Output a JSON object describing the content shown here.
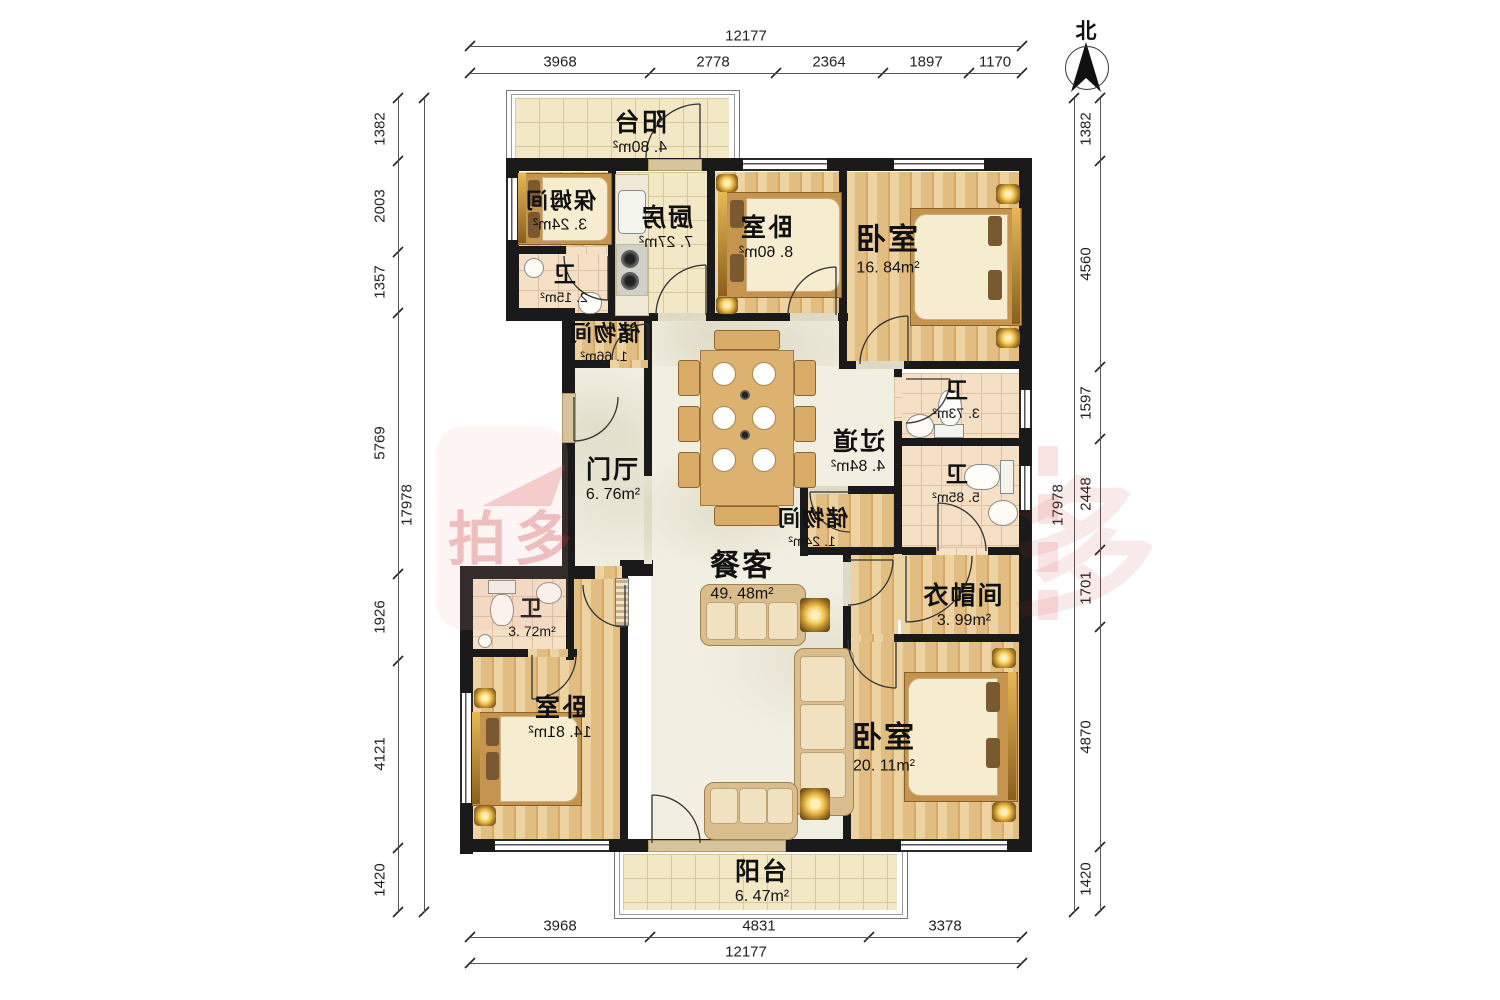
{
  "compass": {
    "label": "北"
  },
  "watermark": {
    "left_text": "拍多",
    "right_text": "多"
  },
  "dims": {
    "top": {
      "total": "12177",
      "segments": [
        "3968",
        "2778",
        "2364",
        "1897",
        "1170"
      ]
    },
    "bottom": {
      "total": "12177",
      "segments": [
        "3968",
        "4831",
        "3378"
      ]
    },
    "left": {
      "total": "17978",
      "segments": [
        "1382",
        "2003",
        "1357",
        "5769",
        "1926",
        "4121",
        "1420"
      ]
    },
    "right": {
      "total": "17978",
      "segments": [
        "1382",
        "4560",
        "1597",
        "2448",
        "1701",
        "4870",
        "1420"
      ]
    }
  },
  "rooms": [
    {
      "name": "阳台",
      "area": "4. 80m²"
    },
    {
      "name": "保姆间",
      "area": "3. 24m²"
    },
    {
      "name": "厨房",
      "area": "7. 27m²"
    },
    {
      "name": "卧室",
      "area": "8. 60m²"
    },
    {
      "name": "卧室",
      "area": "16. 84m²"
    },
    {
      "name": "卫",
      "area": "2. 15m²"
    },
    {
      "name": "储物间",
      "area": "1. 66m²"
    },
    {
      "name": "门厅",
      "area": "6. 76m²"
    },
    {
      "name": "卫",
      "area": "3. 73m²"
    },
    {
      "name": "过道",
      "area": "4. 84m²"
    },
    {
      "name": "卫",
      "area": "5. 85m²"
    },
    {
      "name": "储物间",
      "area": "1. 24m²"
    },
    {
      "name": "餐客",
      "area": "49. 48m²"
    },
    {
      "name": "衣帽间",
      "area": "3. 99m²"
    },
    {
      "name": "卫",
      "area": "3. 72m²"
    },
    {
      "name": "卧室",
      "area": "14. 81m²"
    },
    {
      "name": "卧室",
      "area": "20. 11m²"
    },
    {
      "name": "阳台",
      "area": "6. 47m²"
    }
  ]
}
